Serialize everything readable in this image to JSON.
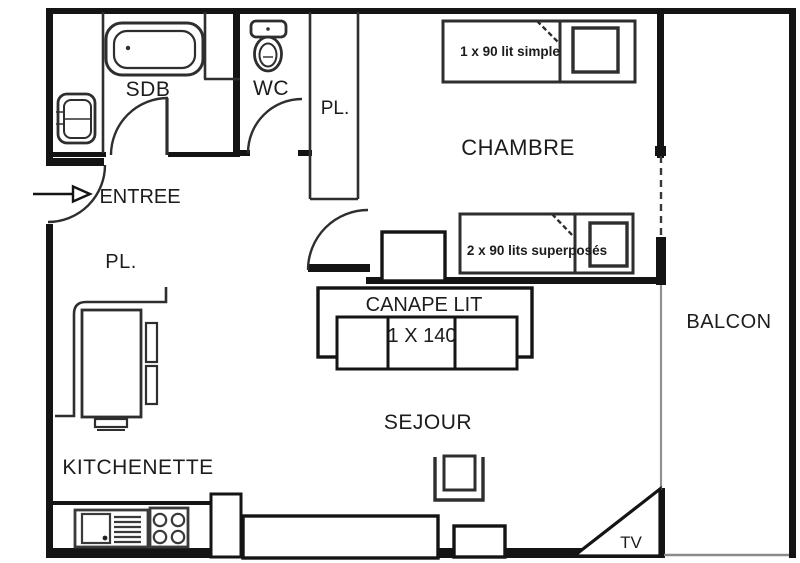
{
  "plan": {
    "rooms": {
      "sdb": "SDB",
      "wc": "WC",
      "entree": "ENTREE",
      "chambre": "CHAMBRE",
      "sejour": "SEJOUR",
      "kitchenette": "KITCHENETTE",
      "balcon": "BALCON"
    },
    "closets": {
      "corridor": "PL.",
      "entry_hall": "PL."
    },
    "furniture": {
      "single_bed": "1 x 90 lit simple",
      "bunk_beds": "2 x 90 lits superposés",
      "sofa_title": "CANAPE LIT",
      "sofa_size": "1 X 140",
      "tv": "TV"
    },
    "colors": {
      "wall": "#141414",
      "line": "#2e2e2e",
      "fixture_line": "#3a3a3a",
      "muted_line": "#909090",
      "background": "#ffffff",
      "text": "#1c1c1c"
    }
  }
}
